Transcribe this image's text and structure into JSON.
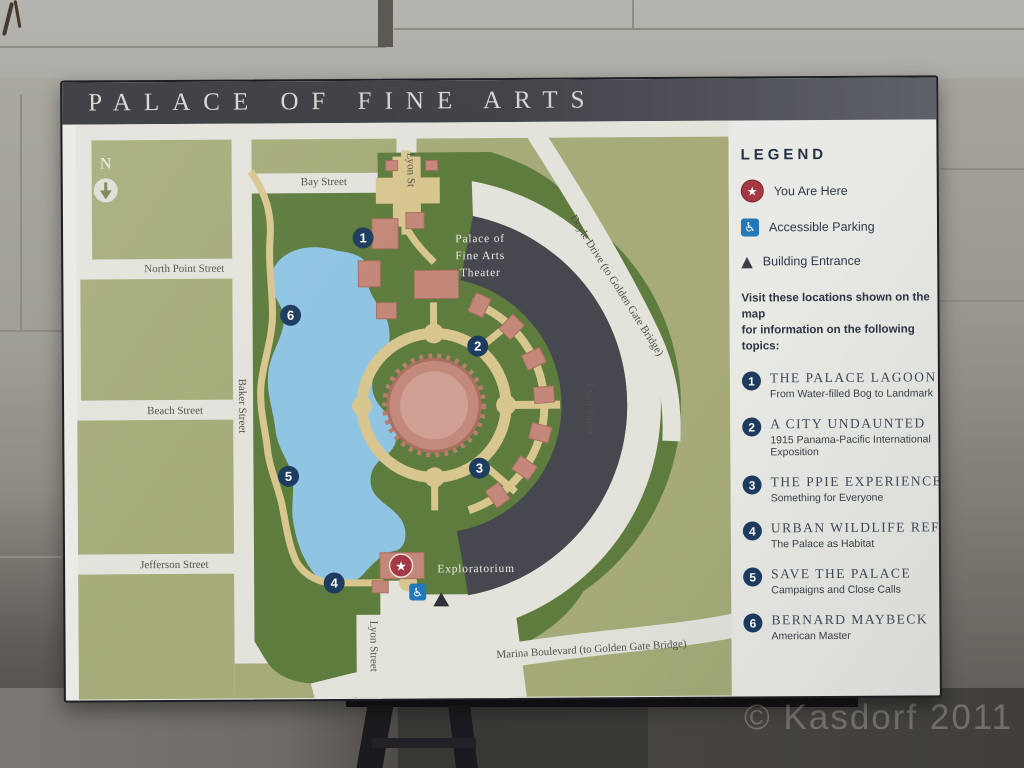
{
  "sign": {
    "title": "PALACE OF FINE ARTS"
  },
  "map": {
    "north_label": "N",
    "streets": {
      "bay": "Bay Street",
      "lyon_top": "Lyon St",
      "north_point": "North Point Street",
      "beach": "Beach Street",
      "jefferson": "Jefferson Street",
      "baker": "Baker Street",
      "doyle": "Doyle Drive (to Golden Gate Bridge)",
      "lyon_mid": "Lyon Street",
      "lyon_bottom": "Lyon Street",
      "marina": "Marina Boulevard (to Golden Gate Bridge)"
    },
    "labels": {
      "theater_lines": [
        "Palace of",
        "Fine Arts",
        "Theater"
      ],
      "exploratorium": "Exploratorium"
    },
    "markers": [
      {
        "number": "1"
      },
      {
        "number": "2"
      },
      {
        "number": "3"
      },
      {
        "number": "4"
      },
      {
        "number": "5"
      },
      {
        "number": "6"
      }
    ],
    "you_are_here_symbol": "★"
  },
  "legend": {
    "heading": "LEGEND",
    "icons": {
      "star": "★",
      "wheelchair": "♿",
      "triangle": "▲"
    },
    "items": [
      {
        "label": "You Are Here"
      },
      {
        "label": "Accessible Parking"
      },
      {
        "label": "Building Entrance"
      }
    ],
    "intro_lines": [
      "Visit these locations shown on the map",
      "for information on the following topics:"
    ],
    "topics": [
      {
        "num": "1",
        "title": "THE PALACE LAGOON",
        "subtitle": "From Water-filled Bog to Landmark"
      },
      {
        "num": "2",
        "title": "A CITY UNDAUNTED",
        "subtitle": "1915 Panama-Pacific International Exposition"
      },
      {
        "num": "3",
        "title": "THE PPIE EXPERIENCE",
        "subtitle": "Something for Everyone"
      },
      {
        "num": "4",
        "title": "URBAN WILDLIFE REFUGE",
        "subtitle": "The Palace as Habitat"
      },
      {
        "num": "5",
        "title": "SAVE THE PALACE",
        "subtitle": "Campaigns and Close Calls"
      },
      {
        "num": "6",
        "title": "BERNARD MAYBECK",
        "subtitle": "American Master"
      }
    ]
  },
  "photo": {
    "watermark": "© Kasdorf 2011"
  },
  "colors": {
    "navy": "#1d3c5f",
    "red": "#a43843",
    "blue": "#2278b9",
    "olive": "#a6ab79",
    "park_green": "#5e7c3e",
    "lagoon": "#8fc4e3",
    "path_tan": "#d8c68f",
    "building_salmon": "#c4887a",
    "crescent": "#47474f"
  }
}
